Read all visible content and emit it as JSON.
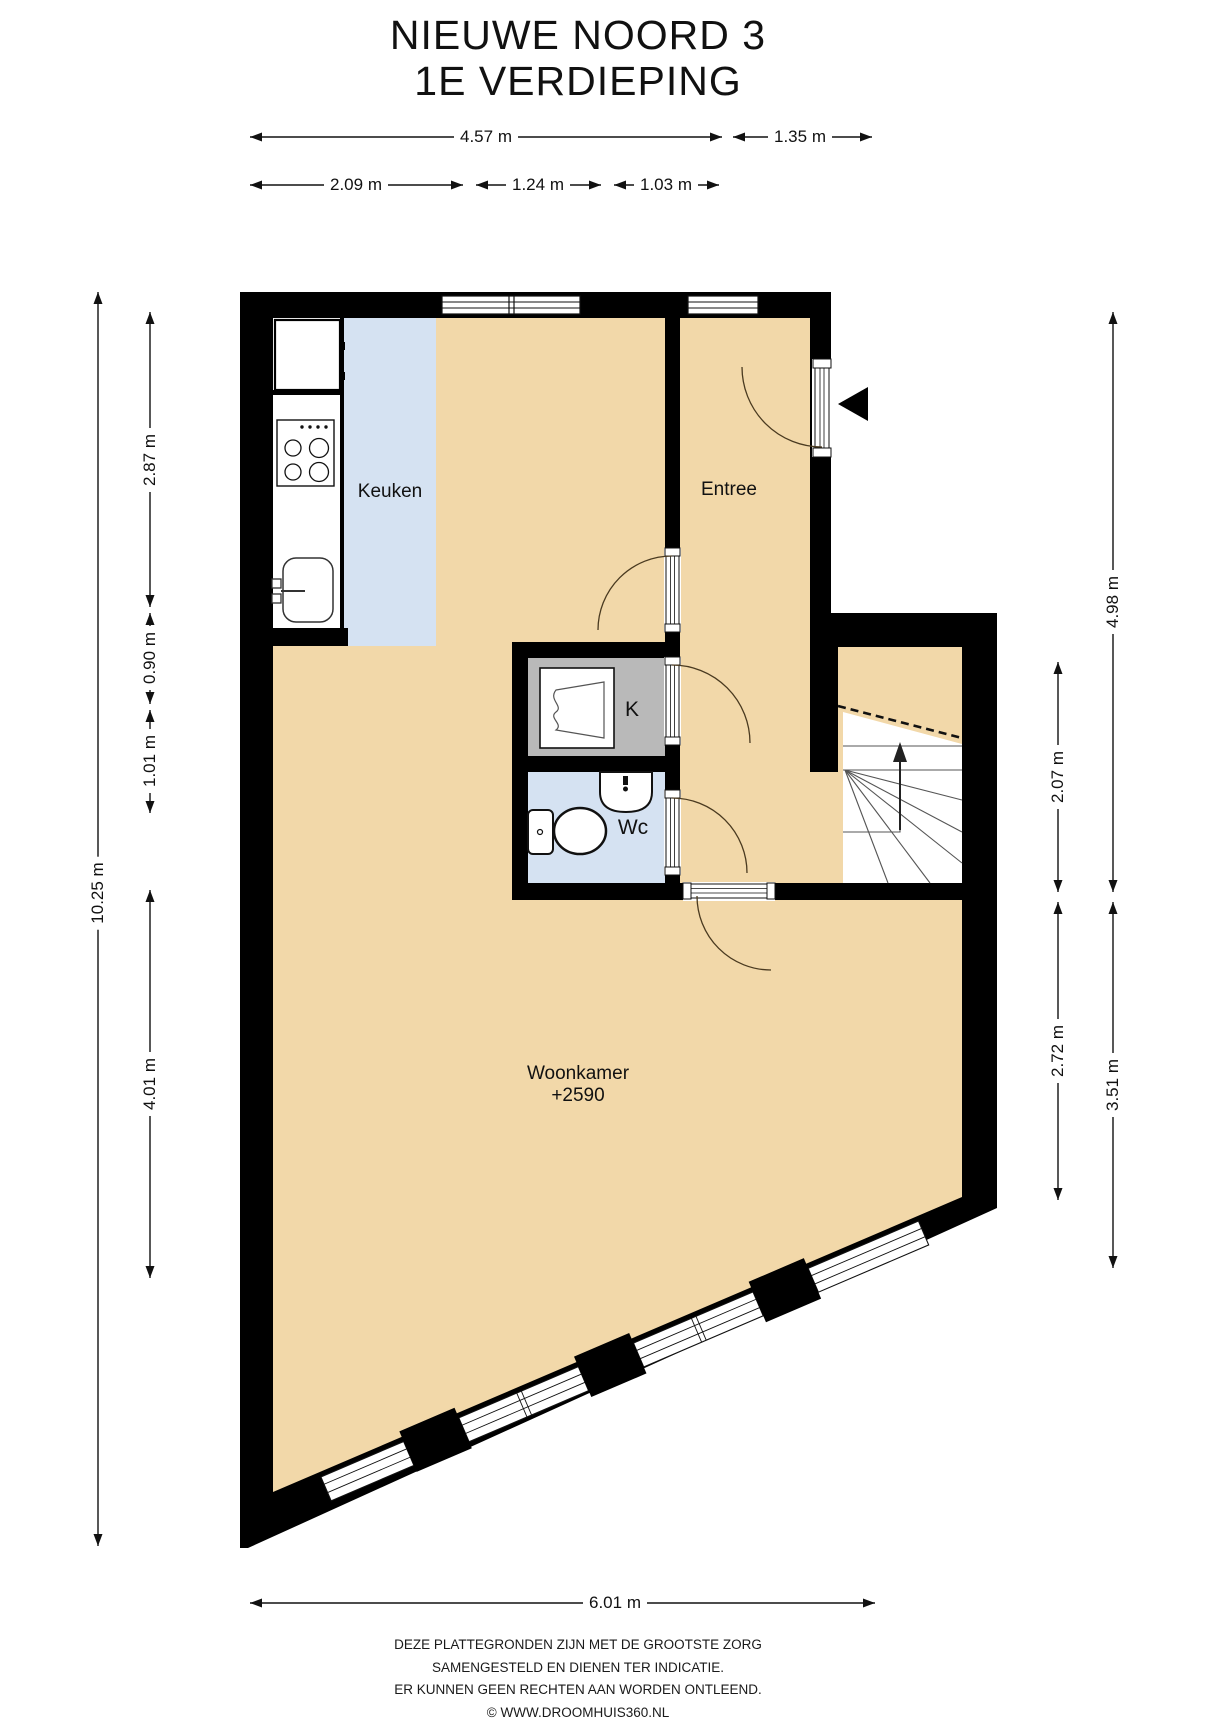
{
  "title": {
    "line1": "NIEUWE NOORD 3",
    "line2": "1E VERDIEPING"
  },
  "rooms": {
    "keuken": "Keuken",
    "entree": "Entree",
    "closet": "K",
    "wc": "Wc",
    "woonkamer": "Woonkamer",
    "woonkamer_level": "+2590"
  },
  "dimensions": {
    "top_row1": [
      "4.57 m",
      "1.35 m"
    ],
    "top_row2": [
      "2.09 m",
      "1.24 m",
      "1.03 m"
    ],
    "left_outer": "10.25 m",
    "left_inner": [
      "2.87 m",
      "0.90 m",
      "1.01 m",
      "4.01 m"
    ],
    "right_inner": [
      "2.07 m",
      "2.72 m"
    ],
    "right_outer": [
      "4.98 m",
      "3.51 m"
    ],
    "bottom": "6.01 m"
  },
  "footer": {
    "line1": "DEZE PLATTEGRONDEN ZIJN MET DE GROOTSTE ZORG",
    "line2": "SAMENGESTELD EN DIENEN TER INDICATIE.",
    "line3": "ER KUNNEN GEEN RECHTEN AAN WORDEN ONTLEEND.",
    "line4": "© WWW.DROOMHUIS360.NL"
  },
  "icons": {
    "entrance_arrow": "left-pointing-triangle",
    "stairs_direction": "up-arrow"
  },
  "colors": {
    "wall": "#000000",
    "floor": "#f2d8a9",
    "wet_floor": "#d5e2f2",
    "closet_floor": "#b9b9b9",
    "background": "#ffffff"
  }
}
